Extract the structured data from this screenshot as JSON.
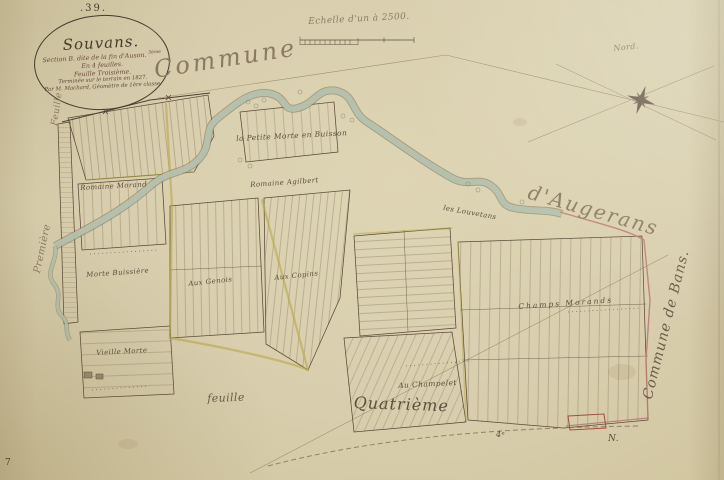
{
  "page": {
    "sheet_number": ".39.",
    "corner_mark": "7"
  },
  "cartouche": {
    "commune_name": "Souvans.",
    "section_line": "Section B. dite de la fin d'Auson.",
    "section_suffix": "3ème",
    "feuilles_line": "En 4 feuilles.",
    "feuille_line": "Feuille Troisième.",
    "survey_line": "Terminée sur le terrain en 1827.",
    "surveyor_line": "Par M. Machard, Géomètre de 1ère classe."
  },
  "scale": {
    "label": "Echelle d'un à 2500."
  },
  "compass": {
    "north_label": "Nord."
  },
  "neighbors": {
    "top": "Commune",
    "top_right": "d'Augerans",
    "right": "Commune de Bans.",
    "left_upper": "Feuille",
    "left_lower": "Première",
    "bottom_left": "feuille",
    "bottom_center": "Quatrième",
    "bottom_right_mark1": "4ᵉ",
    "bottom_right_mark2": "N."
  },
  "place_labels": [
    {
      "text": "la Petite Morte en Buisson"
    },
    {
      "text": "Romaine Morand"
    },
    {
      "text": "Romaine Agilbert"
    },
    {
      "text": "les Louvetans"
    },
    {
      "text": "Morte Buissière"
    },
    {
      "text": "Aux Genois"
    },
    {
      "text": "Aux Copins"
    },
    {
      "text": "Vieille Morte"
    },
    {
      "text": "Champs Morands"
    },
    {
      "text": "Au Champelet"
    }
  ],
  "colors": {
    "paper": "#d8cead",
    "ink": "#4e4033",
    "red_ink": "#a14f3f",
    "boundary_pink": "#b97c74",
    "road_yellow": "#b7a748",
    "water": "#b5c3af"
  }
}
